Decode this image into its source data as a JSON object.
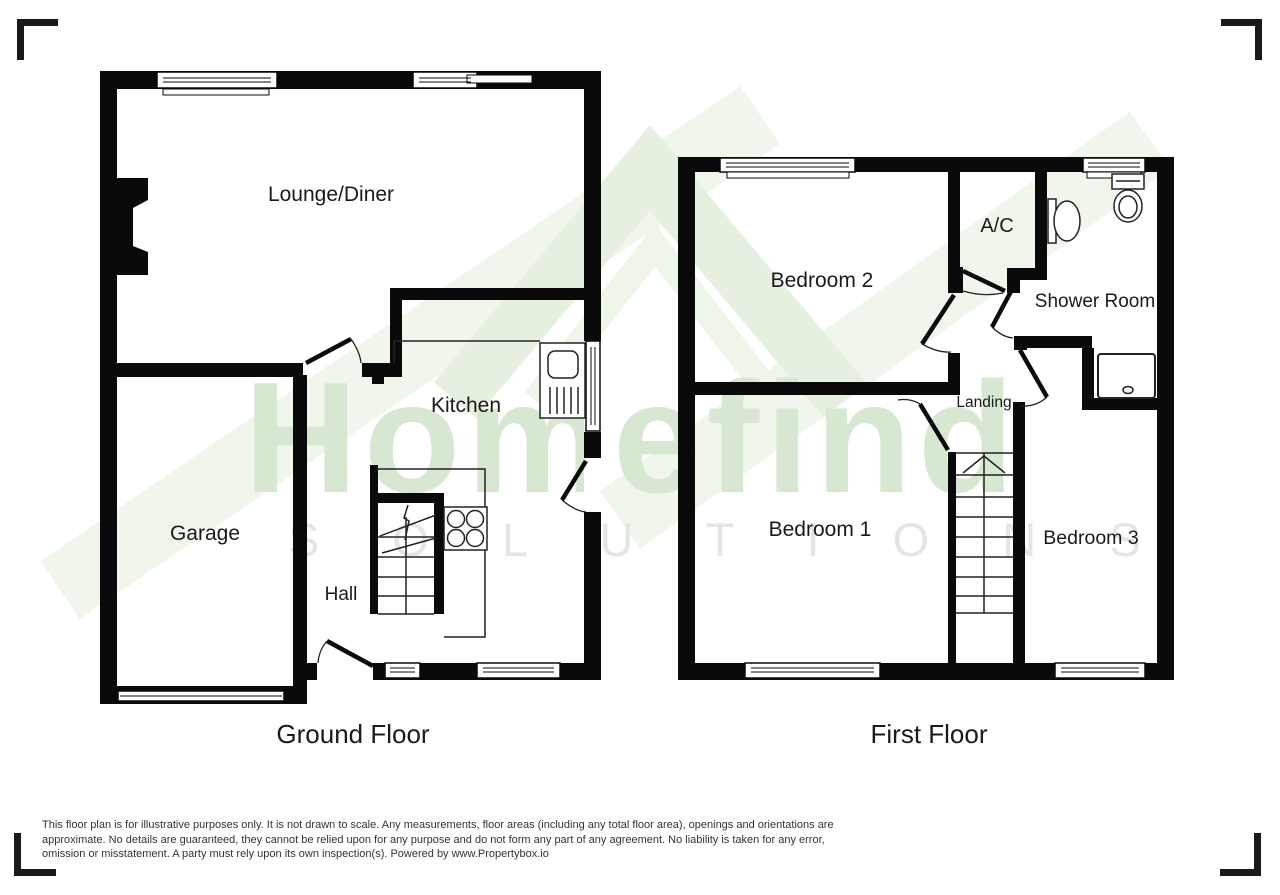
{
  "watermark": {
    "brand": "Homefind",
    "sub": "S O L U T I O N S",
    "brand_color": "#d7e7d2",
    "sub_color": "#e2e7e0",
    "roof_color": "#e6f0e0",
    "stripe_color": "#f0f6ec"
  },
  "colors": {
    "wall": "#0a0a0a",
    "label": "#1a1a1a"
  },
  "ground_floor": {
    "title": "Ground Floor",
    "rooms": {
      "lounge": {
        "label": "Lounge/Diner"
      },
      "kitchen": {
        "label": "Kitchen"
      },
      "garage": {
        "label": "Garage"
      },
      "hall": {
        "label": "Hall"
      }
    },
    "fixtures": [
      "staircase",
      "hob",
      "sink-drainer",
      "garage-door",
      "windows",
      "door-swings",
      "chimney-breast"
    ]
  },
  "first_floor": {
    "title": "First Floor",
    "rooms": {
      "bedroom2": {
        "label": "Bedroom 2"
      },
      "ac": {
        "label": "A/C"
      },
      "shower": {
        "label": "Shower Room"
      },
      "landing": {
        "label": "Landing"
      },
      "bedroom1": {
        "label": "Bedroom 1"
      },
      "bedroom3": {
        "label": "Bedroom 3"
      }
    },
    "fixtures": [
      "staircase",
      "toilet",
      "basin",
      "shower-tray",
      "windows",
      "door-swings"
    ]
  },
  "disclaimer": {
    "line1": "This floor plan is for illustrative purposes only. It is not drawn to scale. Any measurements, floor areas (including any total floor area), openings and orientations are",
    "line2": "approximate. No details are guaranteed, they cannot be relied upon for any purpose and do not form any part of any agreement. No liability is taken for any error,",
    "line3": "omission or misstatement. A party must rely upon its own inspection(s). Powered by www.Propertybox.io"
  }
}
